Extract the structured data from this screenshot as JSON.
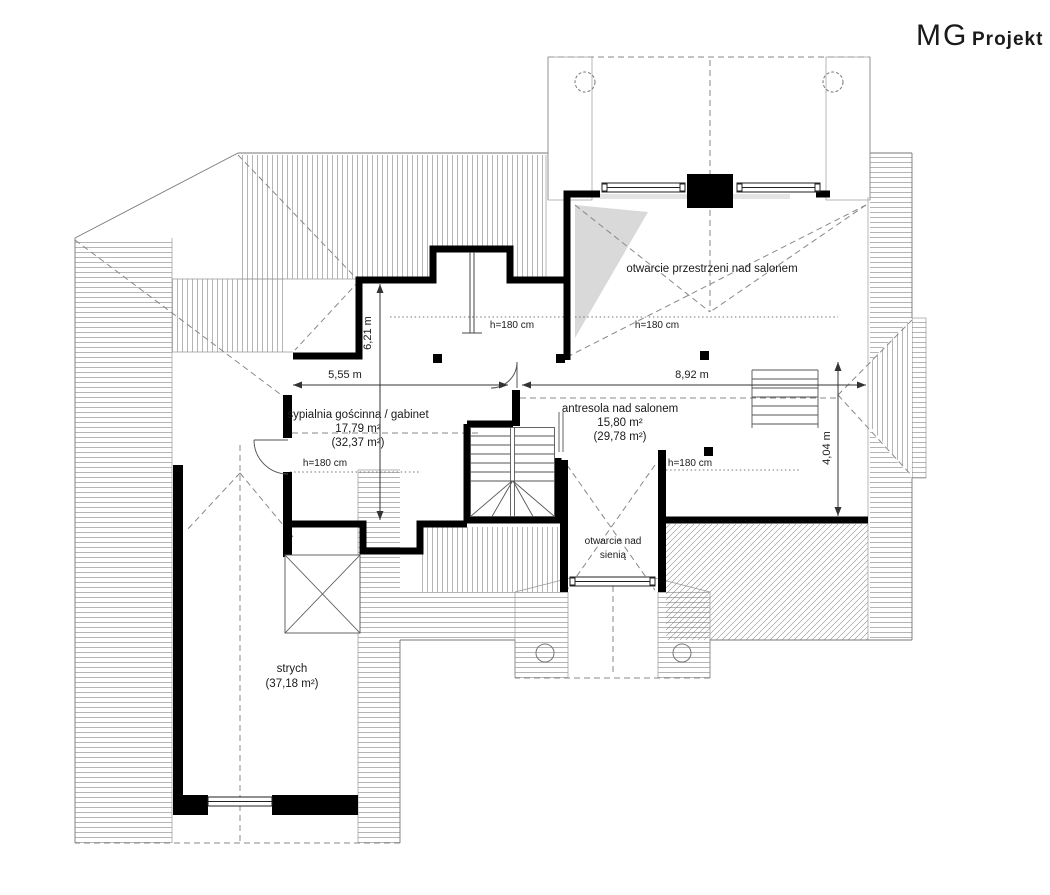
{
  "logo": {
    "mg": "MG",
    "projekt": "Projekt"
  },
  "plan": {
    "rooms": {
      "open_over_salon": {
        "label": "otwarcie przestrzeni nad salonem"
      },
      "guest_bedroom": {
        "label": "sypialnia gościnna / gabinet",
        "area": "17,79 m²",
        "floor_area": "(32,37 m²)"
      },
      "mezzanine": {
        "label": "antresola nad salonem",
        "area": "15,80 m²",
        "floor_area": "(29,78 m²)"
      },
      "open_over_hall": {
        "label_line1": "otwarcie nad",
        "label_line2": "sienią"
      },
      "attic": {
        "label": "strych",
        "floor_area": "(37,18 m²)"
      }
    },
    "dimensions": {
      "d1": {
        "label": "6,21 m",
        "orientation": "vertical"
      },
      "d2": {
        "label": "5,55 m",
        "orientation": "horizontal"
      },
      "d3": {
        "label": "8,92 m",
        "orientation": "horizontal"
      },
      "d4": {
        "label": "4,04 m",
        "orientation": "vertical"
      }
    },
    "height_labels": {
      "h1": "h=180 cm",
      "h2": "h=180 cm",
      "h3": "h=180 cm",
      "h4": "h=180 cm"
    }
  },
  "colors": {
    "wall": "#000000",
    "hatch": "#777777",
    "dash_line": "#888888",
    "shade": "#d9d9d9",
    "text": "#1a1a1a"
  }
}
